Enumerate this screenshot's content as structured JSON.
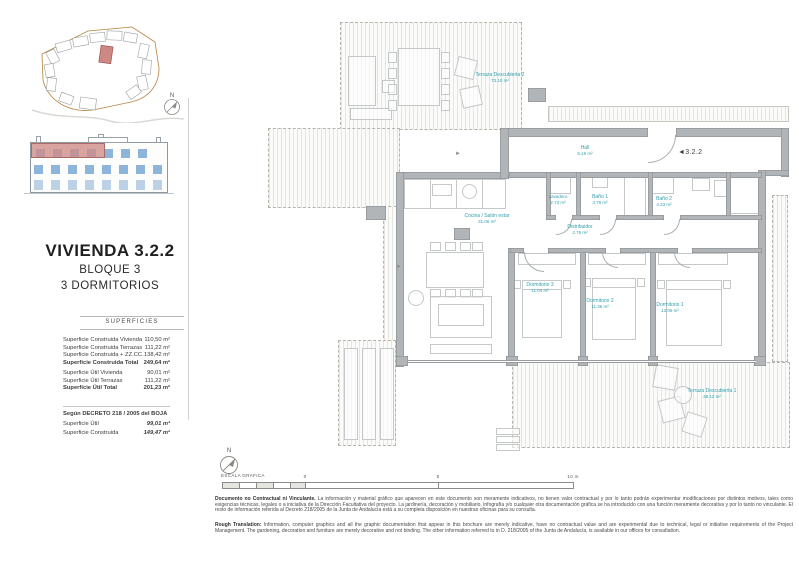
{
  "document": {
    "title": "VIVIENDA 3.2.2",
    "block": "BLOQUE 3",
    "bedrooms": "3 DORMITORIOS"
  },
  "north": "N",
  "surfaces": {
    "header": "SUPERFICIES",
    "rows": [
      {
        "label": "Superficie Construida Vivienda",
        "value": "110,50 m²"
      },
      {
        "label": "Superficie Construida Terrazas",
        "value": "111,22 m²"
      },
      {
        "label": "Superficie Construida + ZZ.CC.",
        "value": "138,42 m²"
      },
      {
        "label": "Superficie Construida Total",
        "value": "249,64 m²"
      },
      {
        "label": "Superficie Útil Vivienda",
        "value": "90,01 m²"
      },
      {
        "label": "Superficie Útil Terrazas",
        "value": "111,22 m²"
      },
      {
        "label": "Superficie Útil Total",
        "value": "201,23 m²"
      }
    ],
    "decree_title": "Según DECRETO 218 / 2005 del BOJA",
    "decree_rows": [
      {
        "label": "Superficie Útil",
        "value": "99,01 m²"
      },
      {
        "label": "Superficie Construida",
        "value": "149,47 m²"
      }
    ]
  },
  "plan": {
    "unit_tag": "3.2.2",
    "entry_arrow": "◄",
    "slope_arrow": "►",
    "rooms": [
      {
        "name": "Hall",
        "area": "5.19 m²"
      },
      {
        "name": "Cocina / Salón estar",
        "area": "31.06 m²"
      },
      {
        "name": "Lavadero",
        "area": "2.73 m²"
      },
      {
        "name": "Baño 1",
        "area": "3.78 m²"
      },
      {
        "name": "Baño 2",
        "area": "4.23 m²"
      },
      {
        "name": "Distribuidor",
        "area": "2.76 m²"
      },
      {
        "name": "Dormitorio 3",
        "area": "11.04 m²"
      },
      {
        "name": "Dormitorio 2",
        "area": "11.36 m²"
      },
      {
        "name": "Dormitorio 1",
        "area": "13.06 m²"
      },
      {
        "name": "Terraza Descubierta 1",
        "area": "38.12 m²"
      },
      {
        "name": "Terraza Descubierta 2",
        "area": "73.10 m²"
      }
    ]
  },
  "scale": {
    "label": "ESCALA GRAFICA",
    "tick_0": "0",
    "tick_5": "5",
    "tick_10": "10 m"
  },
  "disclaimer": {
    "es_lead": "Documento no Contractual ni Vinculante.",
    "es_body": "La información y material gráfico que aparecen en este documento son meramente indicativos, no tienen valor contractual y por lo tanto podrán experimentar modificaciones por distintos motivos, tales como exigencias técnicas, legales o a iniciativa de la Dirección Facultativa del proyecto. La jardinería, decoración y mobiliario, infografía y/o cualquier otra documentación gráfica se ha introducido con una función meramente decorativa y por lo tanto no vinculante. El resto de información referida al Decreto 218/2005 de la Junta de Andalucía está a su completa disposición en nuestras oficinas para su consulta.",
    "en_lead": "Rough Translation:",
    "en_body": "Information, computer graphics and all the graphic documentation that appear in this brochure are merely indicative, have no contractual value and are experimental due to technical, legal or initiative requirements of the Project Management. The gardening, decoration and furniture are merely decorative and not binding. The other information referred to in D. 218/2005 of the Junta de Andalucía, is available in our offices for consultation."
  },
  "colors": {
    "accent_label": "#2f9fae",
    "highlight_red": "#cb8884",
    "window_blue": "#8db4da",
    "boundary_orange": "#b5823f"
  }
}
